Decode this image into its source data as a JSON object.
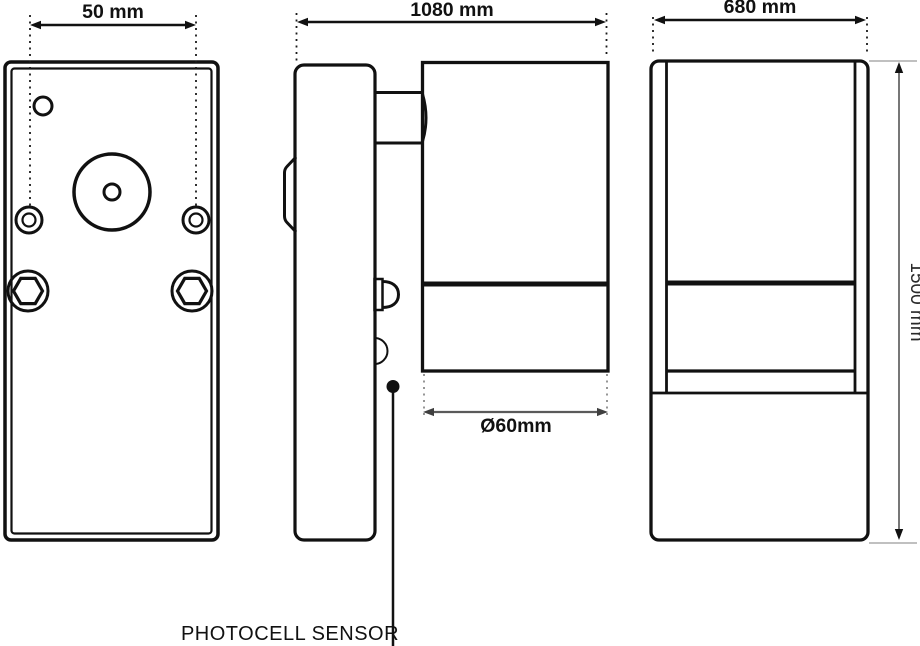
{
  "labels": {
    "back_width": "50 mm",
    "side_width": "1080 mm",
    "front_width": "680 mm",
    "head_diameter": "Ø60mm",
    "overall_height": "1500 mm",
    "photocell": "PHOTOCELL SENSOR"
  },
  "colors": {
    "line": "#111111",
    "dim_secondary": "#5a5a5a",
    "extension_gray": "#8a8a8a",
    "background": "#ffffff"
  }
}
